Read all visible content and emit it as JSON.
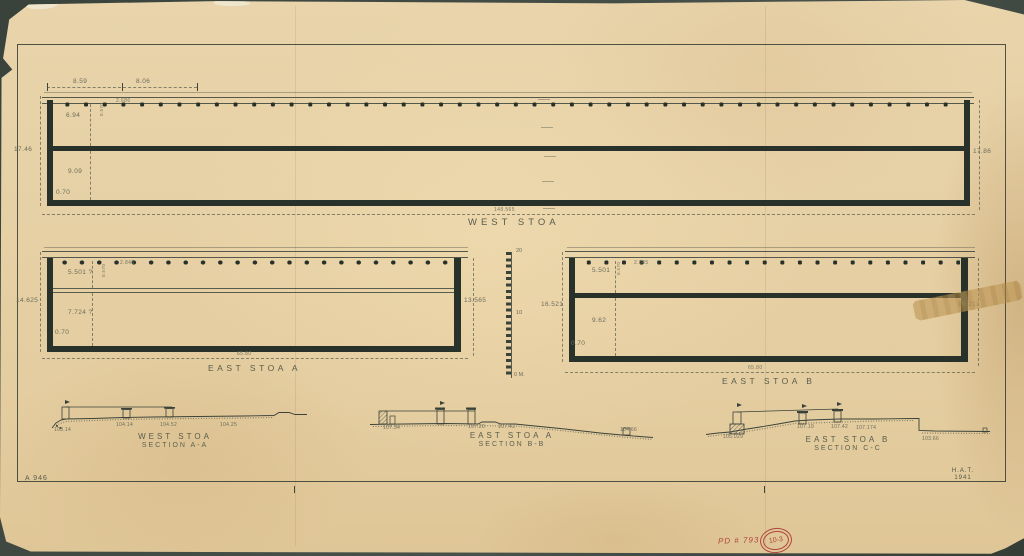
{
  "colors": {
    "paper": "#e9d4ab",
    "ink": "#28322b",
    "dim_text": "#6b6d5a",
    "red": "#b0443a"
  },
  "plans": {
    "west": {
      "label": "WEST STOA",
      "length": "148.565",
      "left_height": "17.46",
      "right_height": "17.86",
      "porch": "6.94",
      "room": "9.09",
      "wall": "0.70",
      "bay1": "8.59",
      "bay2": "8.06",
      "spacing": "2.686",
      "col": "0.570"
    },
    "east_a": {
      "label": "EAST STOA A",
      "length": "65.80",
      "left_height": "14.625",
      "right_height": "13.565",
      "porch": "5.501 ?",
      "room": "7.724 ?",
      "wall": "0.70",
      "spacing": "2.845",
      "col": "0.570"
    },
    "east_b": {
      "label": "EAST STOA B",
      "length": "65.80",
      "left_height": "16.521",
      "right_height": "15.211",
      "porch": "5.501",
      "room": "9.62",
      "wall": "0.70",
      "spacing": "2.845",
      "col": "0.570"
    }
  },
  "scale_bar": {
    "top": "20",
    "mid": "10",
    "bottom": "0 M."
  },
  "sections": [
    {
      "title": "WEST STOA",
      "subtitle": "SECTION A-A",
      "elevations": [
        "103.14",
        "104.14",
        "104.52",
        "104.25"
      ]
    },
    {
      "title": "EAST STOA A",
      "subtitle": "SECTION B-B",
      "elevations": [
        "107.34",
        "107.20",
        "107.43",
        "104.66"
      ]
    },
    {
      "title": "EAST STOA B",
      "subtitle": "SECTION C-C",
      "elevations": [
        "105.029",
        "107.19",
        "107.42",
        "107.174",
        "103.66"
      ]
    }
  ],
  "notes": {
    "sheet_no": "A 946",
    "credit": "H.A.T.",
    "year": "1941",
    "pd_number": "PD # 793",
    "stamp": "10-3"
  }
}
